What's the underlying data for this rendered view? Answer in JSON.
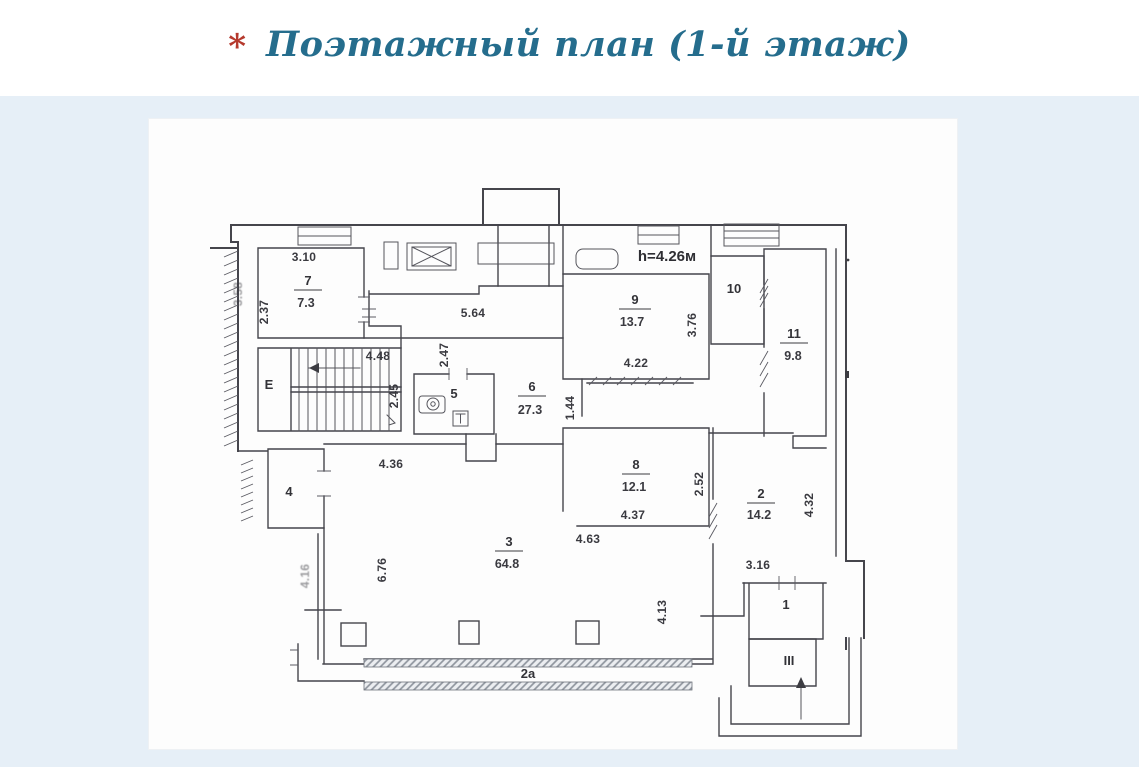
{
  "page": {
    "background": "#ffffff",
    "band_background": "#e6eff7",
    "panel_background": "#fdfdfd"
  },
  "title": {
    "bullet": "*",
    "bullet_color": "#b5392d",
    "text": "Поэтажный план (1-й этаж)",
    "color": "#256d8d"
  },
  "plan": {
    "height_note": "h=4.26м",
    "stairwell_label": "Е",
    "entrance_label": "III",
    "terrace_label": "2а",
    "colors": {
      "line": "#45454c",
      "hatch": "#8f959e"
    },
    "rooms": {
      "r1": {
        "num": "1"
      },
      "r2": {
        "num": "2",
        "area": "14.2"
      },
      "r3": {
        "num": "3",
        "area": "64.8"
      },
      "r4": {
        "num": "4"
      },
      "r5": {
        "num": "5"
      },
      "r6": {
        "num": "6",
        "area": "27.3"
      },
      "r7": {
        "num": "7",
        "area": "7.3"
      },
      "r8": {
        "num": "8",
        "area": "12.1"
      },
      "r9": {
        "num": "9",
        "area": "13.7"
      },
      "r10": {
        "num": "10"
      },
      "r11": {
        "num": "11",
        "area": "9.8"
      }
    },
    "dims": {
      "room7_top": "3.10",
      "room7_left": "2.37",
      "left_edge": "3.58",
      "stair_top": "4.48",
      "stair_right": "2.45",
      "hall_top": "5.64",
      "hall_left": "2.47",
      "corridor": "1.44",
      "room9_bottom": "4.22",
      "room9_right": "3.76",
      "room3_top": "4.36",
      "room3_left": "6.76",
      "room3_left_lower": "4.16",
      "room8_bottom": "4.37",
      "room8_right": "2.52",
      "room8_below": "4.63",
      "room8_lower_right": "4.13",
      "room1_top": "3.16",
      "room2_right": "4.32"
    }
  }
}
